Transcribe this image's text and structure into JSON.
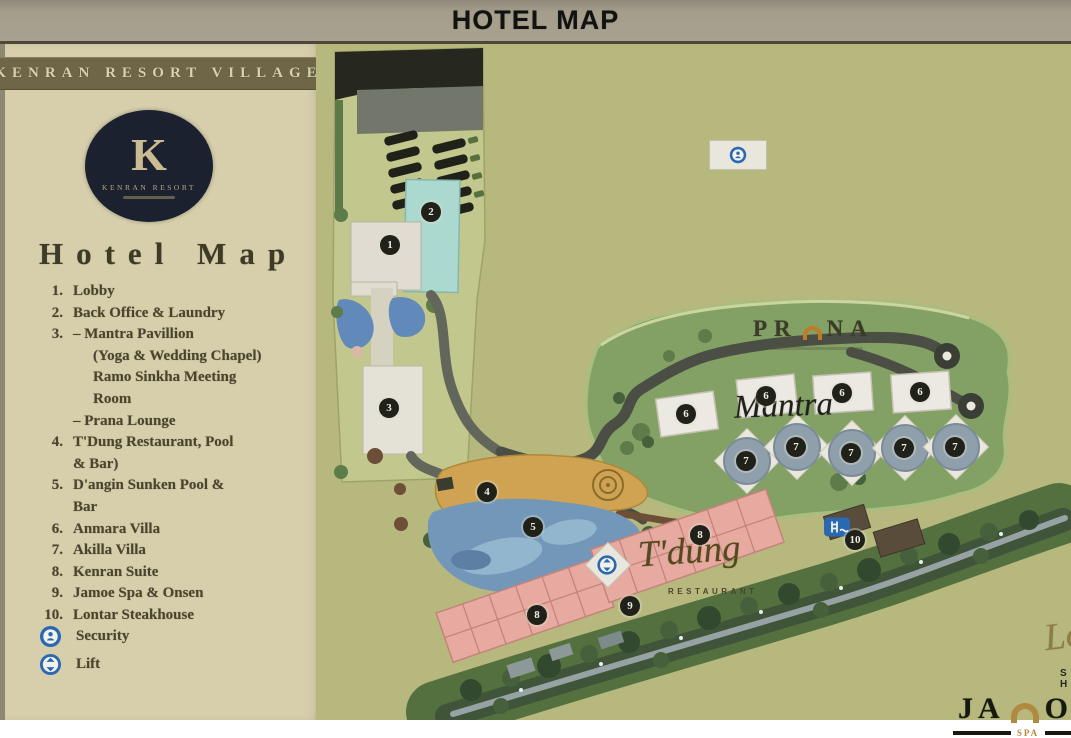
{
  "header": {
    "title": "HOTEL MAP"
  },
  "sidebar": {
    "brand": "KENRAN RESORT VILLAGE",
    "logo": {
      "monogram": "K",
      "name": "KENRAN RESORT"
    },
    "heading": "Hotel Map",
    "items": [
      {
        "num": "1.",
        "label": "Lobby"
      },
      {
        "num": "2.",
        "label": "Back Office & Laundry"
      },
      {
        "num": "3.",
        "label": "– Mantra Pavillion"
      },
      {
        "num": "",
        "label": "(Yoga & Wedding Chapel)"
      },
      {
        "num": "",
        "label": "Ramo Sinkha Meeting"
      },
      {
        "num": "",
        "label": "Room"
      },
      {
        "num": "",
        "label": "– Prana Lounge"
      },
      {
        "num": "4.",
        "label": "T'Dung Restaurant, Pool"
      },
      {
        "num": "",
        "label": "& Bar)"
      },
      {
        "num": "5.",
        "label": "D'angin Sunken Pool &"
      },
      {
        "num": "",
        "label": "Bar"
      },
      {
        "num": "6.",
        "label": "Anmara Villa"
      },
      {
        "num": "7.",
        "label": "Akilla Villa"
      },
      {
        "num": "8.",
        "label": "Kenran Suite"
      },
      {
        "num": "9.",
        "label": "Jamoe Spa & Onsen"
      },
      {
        "num": "10.",
        "label": "Lontar Steakhouse"
      }
    ],
    "legend": [
      {
        "label": "Security"
      },
      {
        "label": "Lift"
      }
    ]
  },
  "map": {
    "labels": {
      "prana_left": "PR",
      "prana_right": "NA",
      "mantra": "Mantra",
      "tdung": "T'dung",
      "tdung_sub": "RESTAURANT",
      "lontar": "Lontar",
      "lontar_sub": "STEAK HOUSE",
      "jamoe_left": "JA",
      "jamoe_right": "OE",
      "jamoe_sub": "SPA"
    },
    "markers": [
      {
        "n": "1"
      },
      {
        "n": "2"
      },
      {
        "n": "3"
      },
      {
        "n": "4"
      },
      {
        "n": "5"
      },
      {
        "n": "6"
      },
      {
        "n": "6"
      },
      {
        "n": "6"
      },
      {
        "n": "6"
      },
      {
        "n": "7"
      },
      {
        "n": "7"
      },
      {
        "n": "7"
      },
      {
        "n": "7"
      },
      {
        "n": "7"
      },
      {
        "n": "8"
      },
      {
        "n": "8"
      },
      {
        "n": "9"
      },
      {
        "n": "10"
      }
    ]
  },
  "colors": {
    "accent_blue": "#2a69b2",
    "marker_dark": "#20221a",
    "gold": "#b08a3e",
    "map_green": "#b6b87e",
    "sidebar_beige": "#d7cfac"
  }
}
